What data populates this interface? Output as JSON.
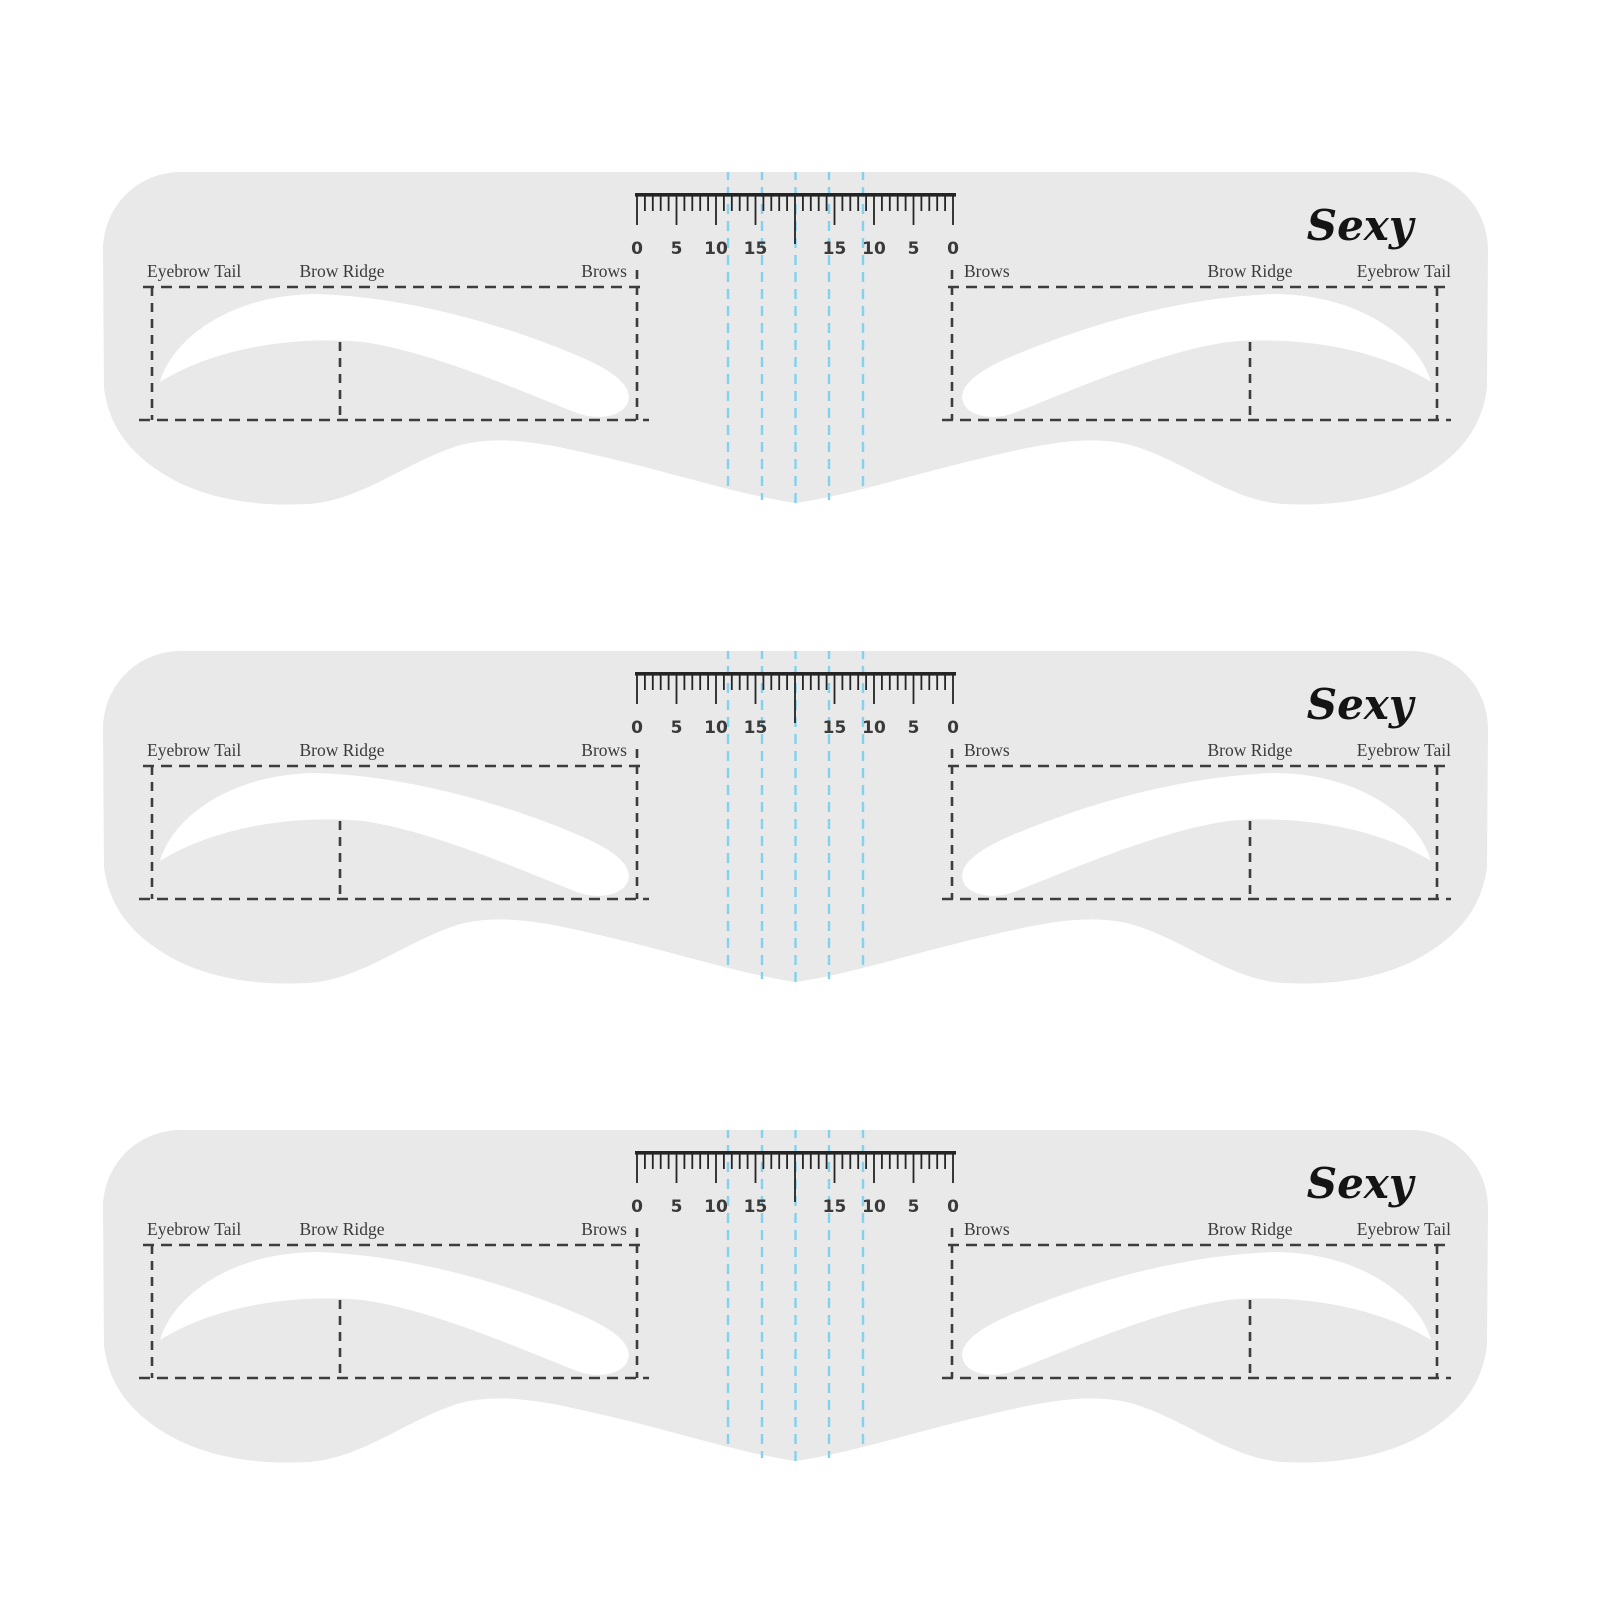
{
  "page": {
    "background": "#ffffff",
    "stencil_count": 3
  },
  "stencil": {
    "brand": "Sexy",
    "labels": {
      "eyebrow_tail": "Eyebrow Tail",
      "brow_ridge": "Brow Ridge",
      "brows": "Brows"
    },
    "ruler": {
      "tick_labels": [
        "0",
        "5",
        "10",
        "15",
        "15",
        "10",
        "5",
        "0"
      ],
      "major_tick_count": 9,
      "minor_ticks_per_major": 4
    },
    "colors": {
      "body": "#e9e9ea",
      "cutout": "#ffffff",
      "guide_blue": "#82d1ee",
      "dash": "#3d3d3d",
      "ruler": "#242424",
      "label_text": "#3a3a3a",
      "brand_text": "#141414"
    }
  }
}
